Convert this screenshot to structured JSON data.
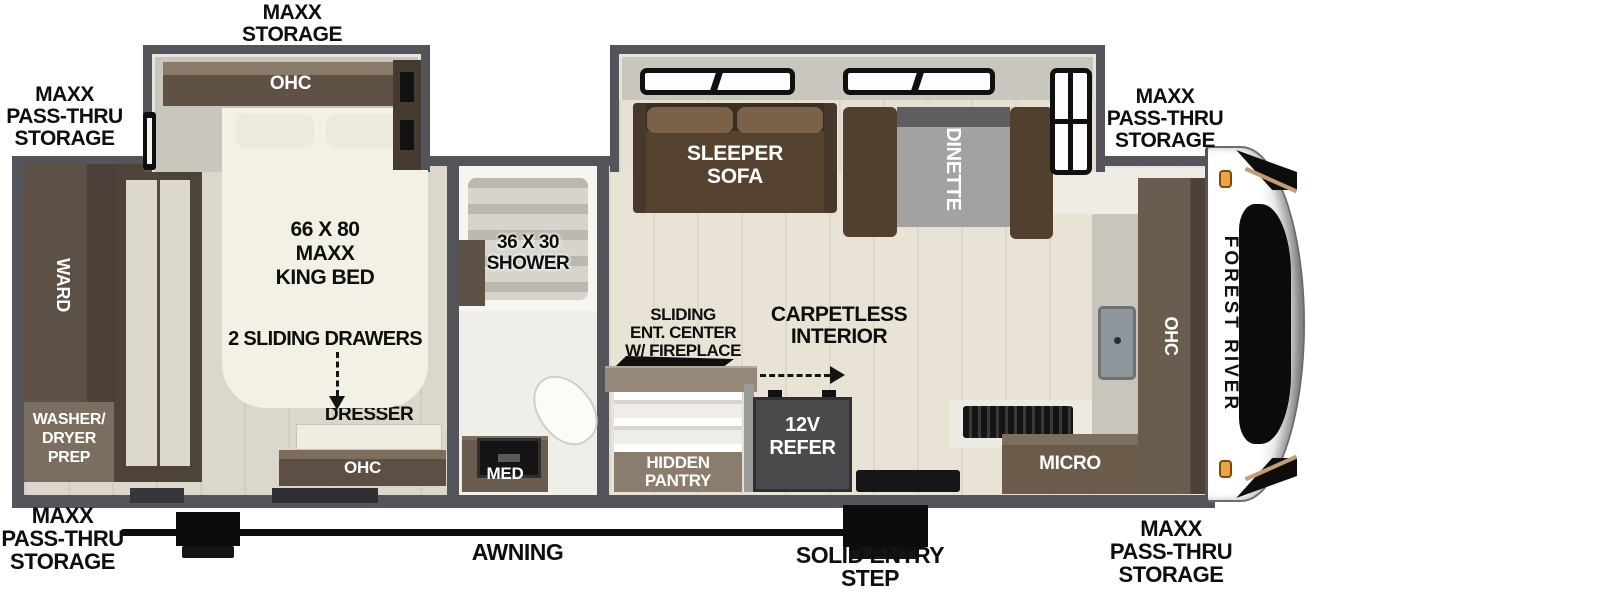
{
  "colors": {
    "wall": "#54555a",
    "cabinet": "#5e5044",
    "cabinet_light": "#8a7a68",
    "sofa": "#55432f",
    "dinette_table": "#a2a2a0",
    "counter": "#c9c5bd",
    "floor_living": "#e9e3d6",
    "floor_bedroom": "#dcd7cc",
    "bed": "#f3f0e6",
    "refer": "#4a4a4c",
    "amber_light": "#f0a43e",
    "line_black": "#0d0d0d"
  },
  "exterior": {
    "storage_top": [
      "MAXX",
      "STORAGE"
    ],
    "storage_top_left": [
      "MAXX",
      "PASS-THRU",
      "STORAGE"
    ],
    "storage_top_right": [
      "MAXX",
      "PASS-THRU",
      "STORAGE"
    ],
    "storage_bottom_left": [
      "MAXX",
      "PASS-THRU",
      "STORAGE"
    ],
    "storage_bottom_right": [
      "MAXX",
      "PASS-THRU",
      "STORAGE"
    ],
    "awning": "AWNING",
    "entry_step": [
      "SOLID ENTRY",
      "STEP"
    ],
    "brand": "FOREST RIVER"
  },
  "bedroom": {
    "slide_ohc": "OHC",
    "bed": [
      "66 X 80",
      "MAXX",
      "KING BED"
    ],
    "drawers_note": "2 SLIDING DRAWERS",
    "dresser": "DRESSER",
    "dresser_ohc": "OHC",
    "ward": "WARD",
    "washer_dryer": [
      "WASHER/",
      "DRYER",
      "PREP"
    ]
  },
  "bathroom": {
    "shower": [
      "36 X 30",
      "SHOWER"
    ],
    "med": "MED"
  },
  "living": {
    "sleeper_sofa": [
      "SLEEPER",
      "SOFA"
    ],
    "dinette": "DINETTE",
    "ent_center": [
      "SLIDING",
      "ENT. CENTER",
      "W/ FIREPLACE"
    ],
    "carpetless": [
      "CARPETLESS",
      "INTERIOR"
    ],
    "hidden_pantry": [
      "HIDDEN",
      "PANTRY"
    ],
    "refer": [
      "12V",
      "REFER"
    ]
  },
  "kitchen": {
    "micro": "MICRO",
    "ohc": "OHC"
  }
}
